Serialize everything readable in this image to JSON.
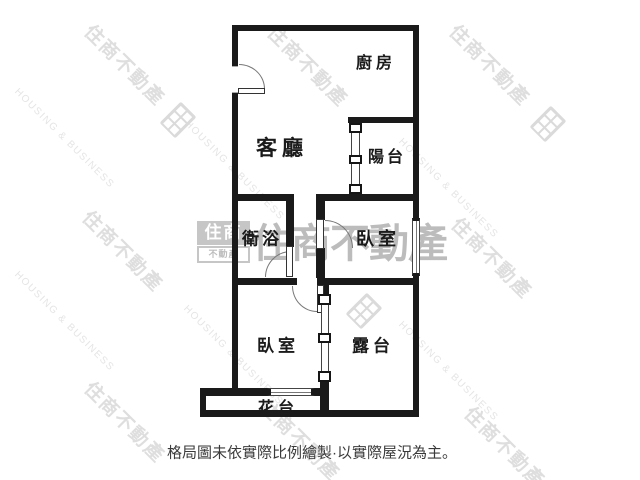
{
  "brand": {
    "name_zh": "住商不動產",
    "name_en": "HOUSING & BUSINESS",
    "logo_top": "住商",
    "logo_bottom": "不動產"
  },
  "floorplan": {
    "rooms": [
      {
        "id": "kitchen",
        "label": "廚房"
      },
      {
        "id": "living-room",
        "label": "客廳"
      },
      {
        "id": "balcony",
        "label": "陽台"
      },
      {
        "id": "bathroom",
        "label": "衛浴"
      },
      {
        "id": "bedroom-upper",
        "label": "臥室"
      },
      {
        "id": "bedroom-lower",
        "label": "臥室"
      },
      {
        "id": "terrace",
        "label": "露台"
      },
      {
        "id": "flower-bed",
        "label": "花台"
      }
    ],
    "caption": "格局圖未依實際比例繪製·以實際屋況為主。"
  },
  "colors": {
    "wall": "#1a1a1a",
    "label": "#1b1b1b",
    "watermark_diagonal": "#dedede",
    "watermark_center": "#bcbcbc",
    "caption": "#3a3a3a"
  }
}
